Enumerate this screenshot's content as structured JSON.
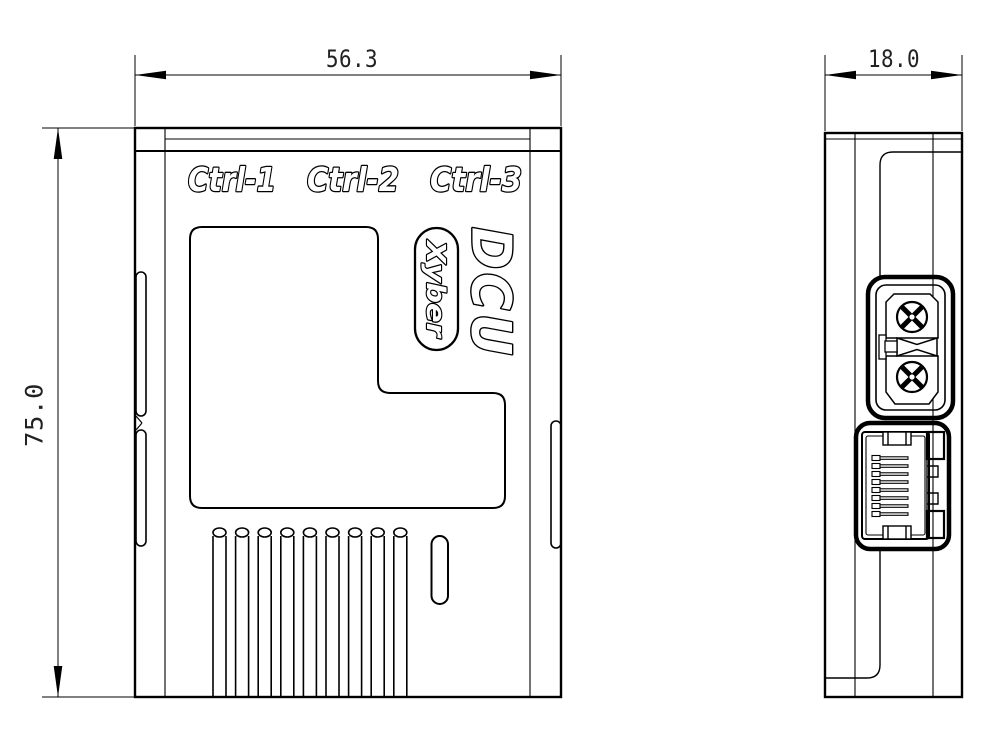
{
  "drawing": {
    "front_view": {
      "width_dim": "56.3",
      "height_dim": "75.0",
      "port_labels": [
        "Ctrl-1",
        "Ctrl-2",
        "Ctrl-3"
      ],
      "product_name": "DCU",
      "brand_badge": "Xyber",
      "vent_count": 9
    },
    "side_view": {
      "depth_dim": "18.0",
      "connectors": [
        "xt30-power-connector",
        "rj45-ethernet-port"
      ]
    },
    "colors": {
      "line": "#000000",
      "background": "#ffffff"
    }
  }
}
